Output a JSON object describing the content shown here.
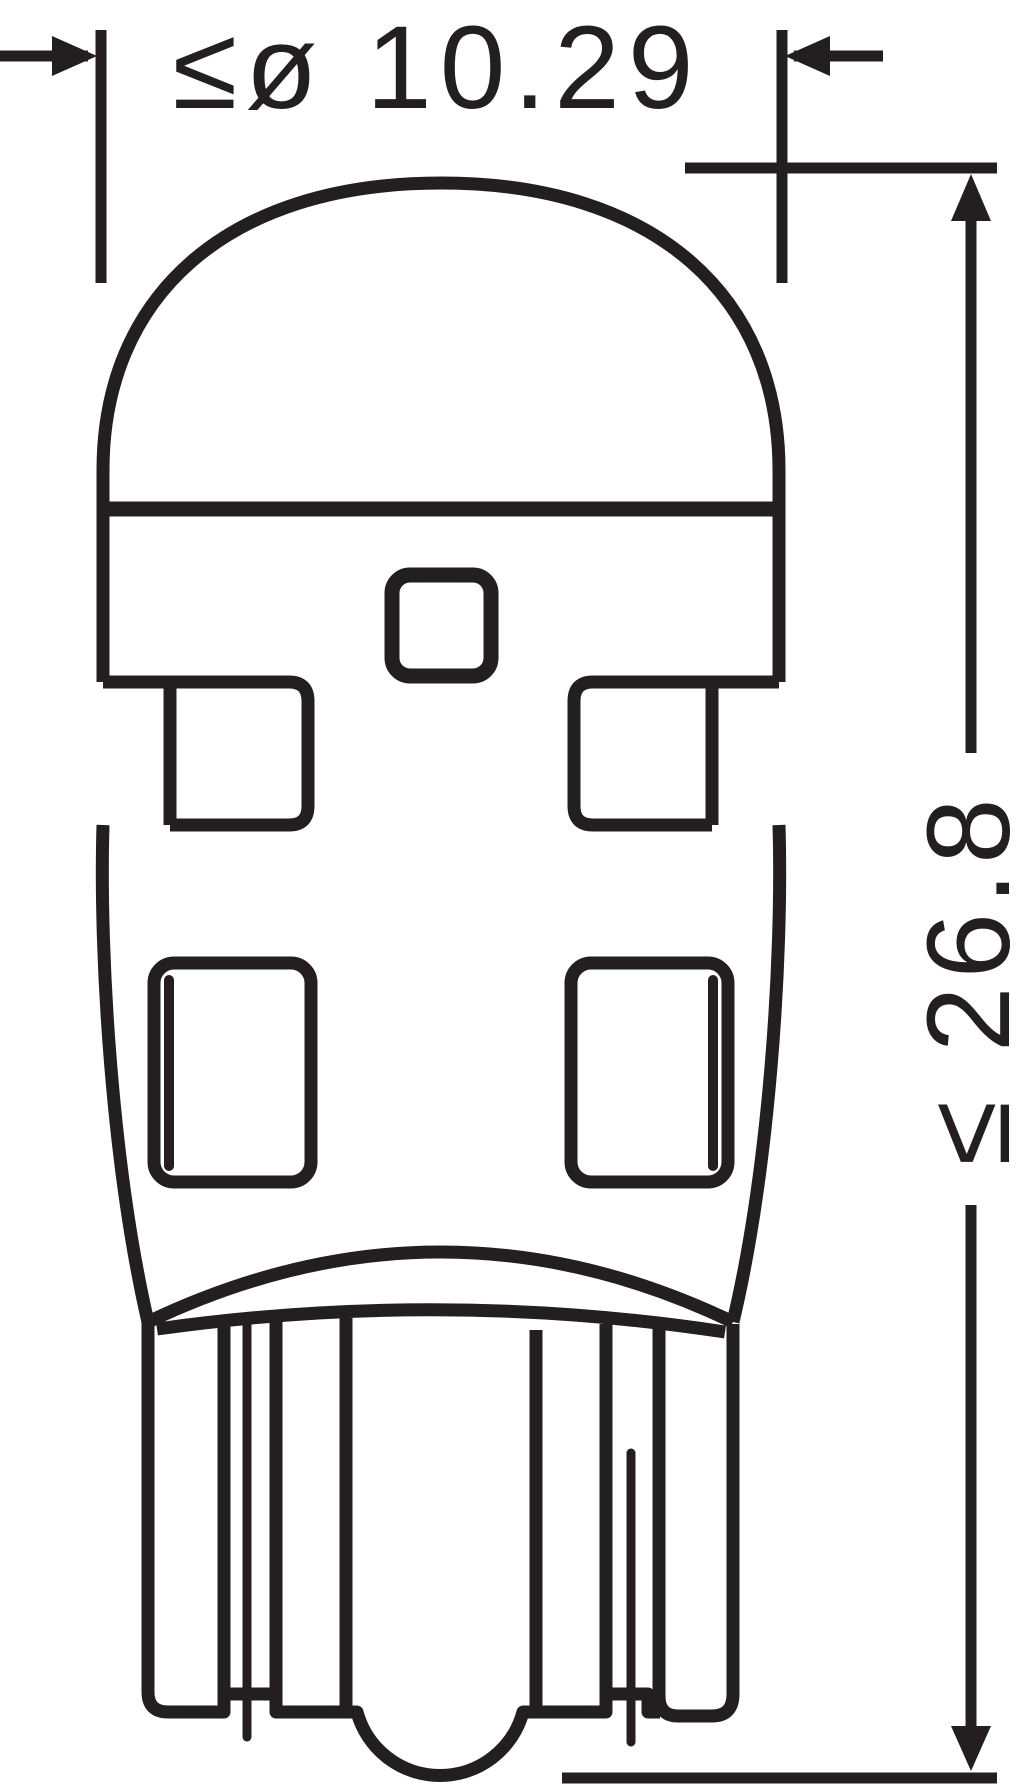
{
  "canvas": {
    "width_px": 1024,
    "height_px": 1784,
    "background": "#ffffff",
    "ink_color": "#231f20"
  },
  "drawing": {
    "subject": "wedge-base LED bulb outline, front view",
    "style": "black line technical dimension drawing",
    "dimensions": {
      "diameter": {
        "label": "≤ø 10.29",
        "value": 10.29,
        "unit": "mm",
        "constraint": "maximum",
        "orientation": "horizontal"
      },
      "length": {
        "label": "≤ 26.8",
        "value": 26.8,
        "unit": "mm",
        "constraint": "maximum",
        "orientation": "vertical, label rotated 90° counterclockwise"
      }
    }
  }
}
